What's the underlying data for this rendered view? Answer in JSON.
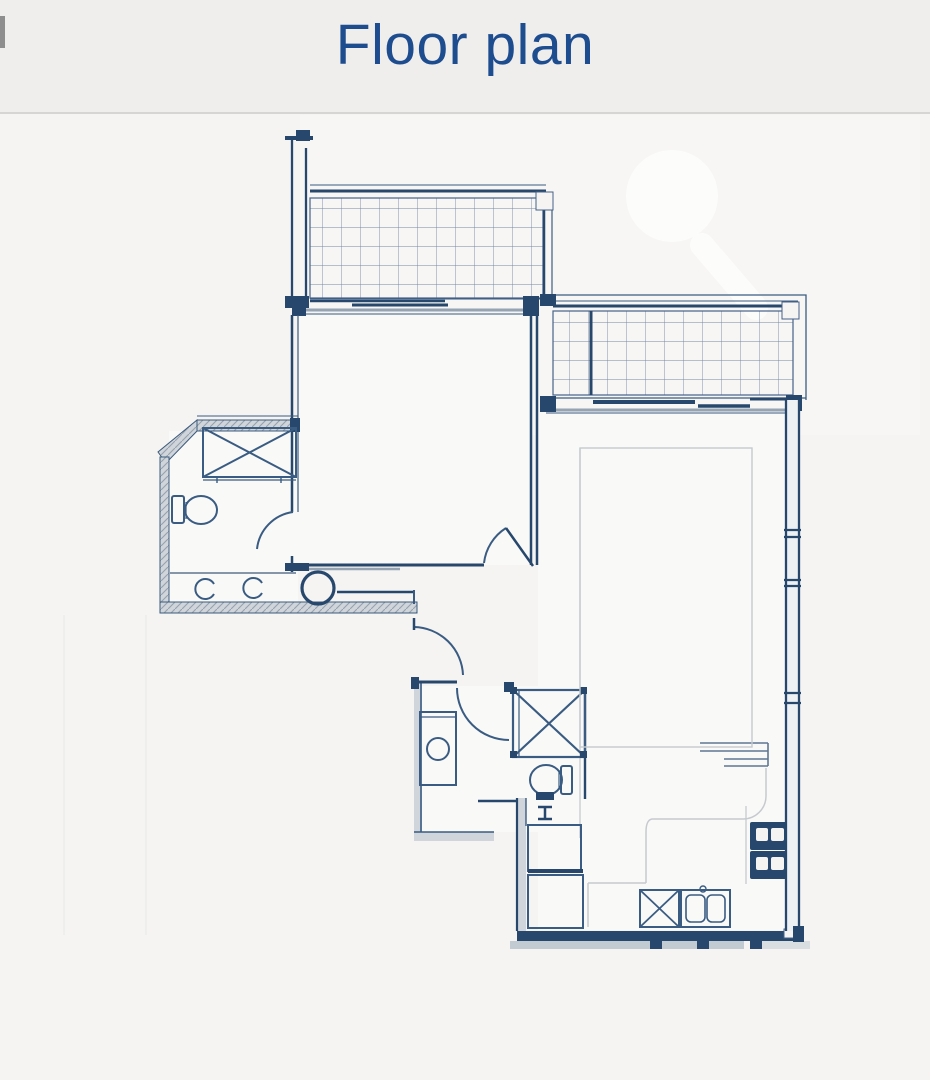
{
  "header": {
    "title": "Floor plan"
  },
  "colors": {
    "title": "#1d4c8f",
    "header_bg": "#efeeec",
    "divider": "#d6d5d3",
    "plan_bg": "#f5f4f2",
    "room_fill": "#f9f9f7",
    "line": "#3a5c82",
    "wall": "#27486c",
    "grid_line": "#7388a3",
    "hatch_fill": "#cfd5da",
    "hatch_line": "#97a1ac",
    "gray_band": "#95a3b2",
    "faint": "#c6cacf"
  }
}
